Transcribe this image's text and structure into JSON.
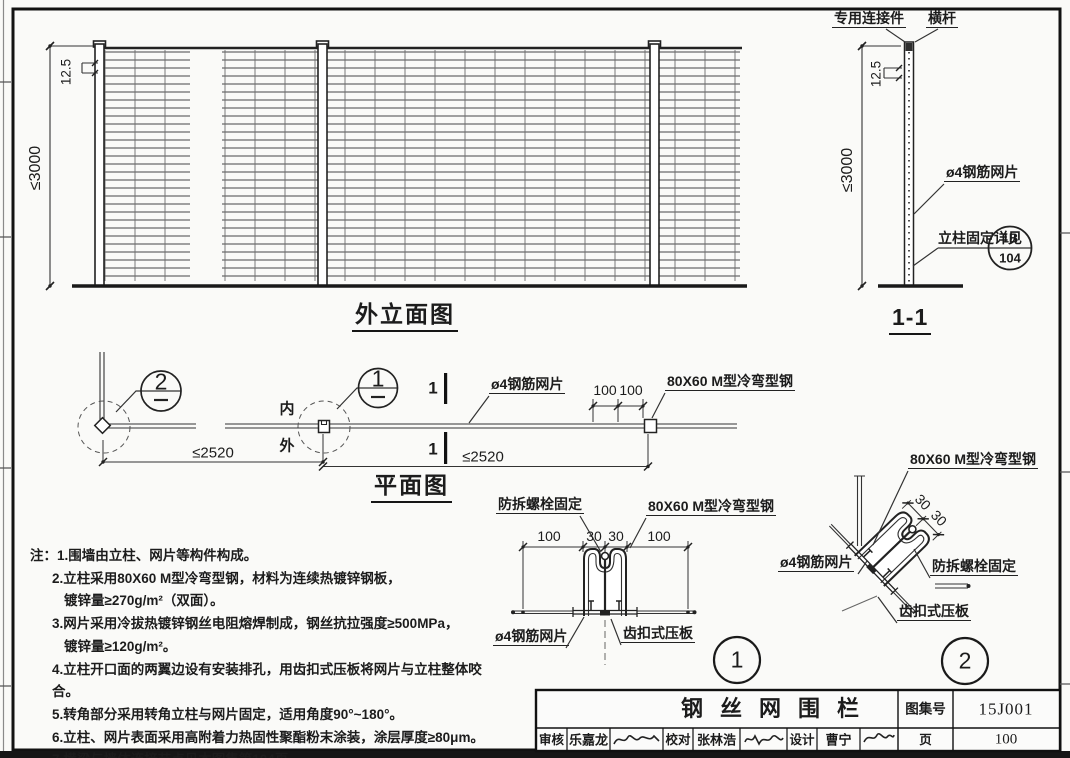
{
  "drawing": {
    "elevation": {
      "title": "外立面图",
      "dim_height": "≤3000",
      "dim_pitch": "12.5"
    },
    "section": {
      "title": "1-1",
      "connector": "专用连接件",
      "rail": "横杆",
      "dim_height": "≤3000",
      "dim_pitch": "12.5",
      "mesh": "ø4钢筋网片",
      "fix_note": "立柱固定详见",
      "detail_ref_top": "1B",
      "detail_ref_bottom": "104"
    },
    "plan": {
      "title": "平面图",
      "inner": "内",
      "outer": "外",
      "mesh": "ø4钢筋网片",
      "post": "80X60 M型冷弯型钢",
      "dim_a": "100",
      "dim_b": "100",
      "span_a": "≤2520",
      "span_b": "≤2520",
      "bubble_1": "1",
      "bubble_2": "2",
      "section_mark": "1"
    },
    "detail1": {
      "bubble": "1",
      "bolt": "防拆螺栓固定",
      "post": "80X60 M型冷弯型钢",
      "mesh": "ø4钢筋网片",
      "clamp": "齿扣式压板",
      "dims": [
        "100",
        "30",
        "30",
        "100"
      ]
    },
    "detail2": {
      "bubble": "2",
      "post": "80X60 M型冷弯型钢",
      "mesh": "ø4钢筋网片",
      "bolt": "防拆螺栓固定",
      "clamp": "齿扣式压板",
      "dim_a": "30",
      "dim_b": "30"
    },
    "notes": {
      "lines": [
        "注：1.围墙由立柱、网片等构件构成。",
        "2.立柱采用80X60  M型冷弯型钢，材料为连续热镀锌钢板，",
        "镀锌量≥270g/m²（双面）。",
        "3.网片采用冷拔热镀锌钢丝电阻熔焊制成，钢丝抗拉强度≥500MPa，",
        "镀锌量≥120g/m²。",
        "4.立柱开口面的两翼边设有安装排孔，用齿扣式压板将网片与立柱整体咬合。",
        "5.转角部分采用转角立柱与网片固定，适用角度90°~180°。",
        "6.立柱、网片表面采用高附着力热固性聚酯粉末涂装，涂层厚度≥80μm。",
        "7.横梁与墙体连接节点见本图集第104页。"
      ]
    },
    "titleblock": {
      "title": "钢丝网围栏",
      "atlas_label": "图集号",
      "atlas_no": "15J001",
      "page_label": "页",
      "page_no": "100",
      "review_label": "审核",
      "reviewer": "乐嘉龙",
      "check_label": "校对",
      "checker": "张林浩",
      "design_label": "设计",
      "designer": "曹宁"
    }
  }
}
